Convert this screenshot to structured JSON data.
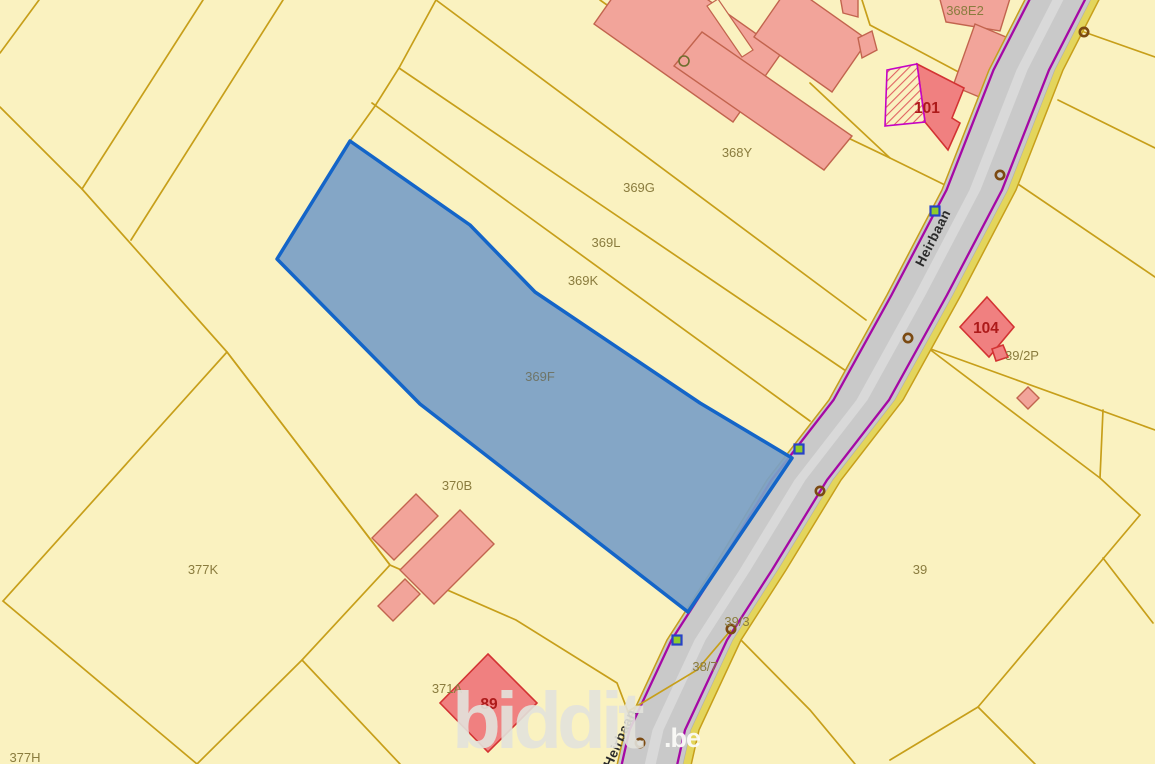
{
  "map": {
    "background": "#FAF2C0",
    "colors": {
      "parcel_line": "#C79F1A",
      "parcel_label": "#8A7C3E",
      "highlight_label": "#6F7568",
      "building_light_fill": "#F2A49A",
      "building_light_stroke": "#C2644E",
      "building_dark_fill": "#F08080",
      "building_dark_stroke": "#D33333",
      "building_number": "#AD1A1A",
      "hatch_line": "#E06060",
      "hatch_border": "#C503C5",
      "road_fill": "#C9C9C9",
      "road_edge": "#AFAFAF",
      "road_stripe": "#D9D9D9",
      "road_purple": "#A508A5",
      "road_band": "#E3D55C",
      "highlight_fill": "#7BA0C6",
      "highlight_stroke": "#1465C8",
      "marker_ring": "#7B4A12",
      "marker_circle": "#6E6E2E",
      "marker_square_stroke": "#2742C8",
      "marker_square_fill": "#8FCC2A",
      "street_text": "#2B2B2B",
      "watermark_main": "#E2E2DC",
      "watermark_suffix": "#FBFBF8"
    },
    "watermark": {
      "text": "biddit",
      "suffix": ".be",
      "x": 452,
      "y": 748,
      "suffix_x": 664,
      "suffix_y": 747
    },
    "street_labels": [
      {
        "text": "Heirbaan",
        "x": 937,
        "y": 240,
        "rotate": -63
      },
      {
        "text": "Heirbaan",
        "x": 624,
        "y": 740,
        "rotate": -66
      }
    ],
    "parcel_labels": [
      {
        "text": "368E2",
        "x": 965,
        "y": 15
      },
      {
        "text": "368Y",
        "x": 737,
        "y": 157
      },
      {
        "text": "369G",
        "x": 639,
        "y": 192
      },
      {
        "text": "369L",
        "x": 606,
        "y": 247
      },
      {
        "text": "369K",
        "x": 583,
        "y": 285
      },
      {
        "text": "370B",
        "x": 457,
        "y": 490
      },
      {
        "text": "377K",
        "x": 203,
        "y": 574
      },
      {
        "text": "377H",
        "x": 25,
        "y": 762
      },
      {
        "text": "371A",
        "x": 447,
        "y": 693
      },
      {
        "text": "39/2P",
        "x": 1022,
        "y": 360
      },
      {
        "text": "39",
        "x": 920,
        "y": 574
      },
      {
        "text": "39/3",
        "x": 737,
        "y": 626
      },
      {
        "text": "38/7",
        "x": 705,
        "y": 671
      }
    ],
    "building_numbers": [
      {
        "text": "101",
        "x": 927,
        "y": 113
      },
      {
        "text": "104",
        "x": 986,
        "y": 333
      },
      {
        "text": "89",
        "x": 489,
        "y": 709
      }
    ],
    "highlight_parcel": {
      "label": {
        "text": "369F",
        "x": 540,
        "y": 381
      },
      "points": [
        [
          350,
          141
        ],
        [
          470,
          225
        ],
        [
          535,
          292
        ],
        [
          700,
          403
        ],
        [
          792,
          458
        ],
        [
          740,
          535
        ],
        [
          688,
          612
        ],
        [
          420,
          404
        ],
        [
          277,
          259
        ]
      ]
    },
    "road": {
      "centerline": [
        [
          1064,
          -12
        ],
        [
          1022,
          70
        ],
        [
          975,
          190
        ],
        [
          920,
          295
        ],
        [
          862,
          400
        ],
        [
          800,
          480
        ],
        [
          745,
          570
        ],
        [
          700,
          640
        ],
        [
          658,
          730
        ],
        [
          644,
          792
        ]
      ],
      "halfwidth": 33
    },
    "boundary_lines": [
      [
        [
          0,
          53
        ],
        [
          39,
          0
        ]
      ],
      [
        [
          0,
          107
        ],
        [
          82,
          189
        ],
        [
          227,
          352
        ]
      ],
      [
        [
          203,
          0
        ],
        [
          82,
          189
        ]
      ],
      [
        [
          283,
          0
        ],
        [
          131,
          240
        ]
      ],
      [
        [
          227,
          352
        ],
        [
          3,
          601
        ],
        [
          197,
          764
        ],
        [
          302,
          660
        ],
        [
          390,
          565
        ],
        [
          227,
          352
        ]
      ],
      [
        [
          302,
          660
        ],
        [
          400,
          764
        ]
      ],
      [
        [
          227,
          352
        ],
        [
          390,
          565
        ],
        [
          516,
          620
        ],
        [
          617,
          683
        ],
        [
          640,
          743
        ],
        [
          658,
          764
        ]
      ],
      [
        [
          350,
          141
        ],
        [
          375,
          106
        ],
        [
          399,
          68
        ],
        [
          436,
          0
        ]
      ],
      [
        [
          436,
          0
        ],
        [
          866,
          320
        ]
      ],
      [
        [
          399,
          68
        ],
        [
          849,
          373
        ]
      ],
      [
        [
          372,
          103
        ],
        [
          810,
          421
        ]
      ],
      [
        [
          600,
          0
        ],
        [
          685,
          60
        ],
        [
          890,
          158
        ],
        [
          947,
          186
        ]
      ],
      [
        [
          810,
          83
        ],
        [
          890,
          158
        ]
      ],
      [
        [
          862,
          0
        ],
        [
          870,
          25
        ],
        [
          998,
          93
        ],
        [
          1016,
          102
        ]
      ],
      [
        [
          1084,
          32
        ],
        [
          1155,
          57
        ]
      ],
      [
        [
          1058,
          100
        ],
        [
          1155,
          148
        ]
      ],
      [
        [
          1012,
          180
        ],
        [
          1155,
          277
        ]
      ],
      [
        [
          928,
          348
        ],
        [
          1155,
          430
        ]
      ],
      [
        [
          928,
          348
        ],
        [
          1100,
          478
        ],
        [
          1140,
          515
        ]
      ],
      [
        [
          1103,
          410
        ],
        [
          1100,
          478
        ]
      ],
      [
        [
          1140,
          515
        ],
        [
          978,
          707
        ]
      ],
      [
        [
          978,
          707
        ],
        [
          1035,
          764
        ]
      ],
      [
        [
          978,
          707
        ],
        [
          890,
          760
        ]
      ],
      [
        [
          1103,
          558
        ],
        [
          1153,
          623
        ]
      ],
      [
        [
          735,
          634
        ],
        [
          810,
          710
        ],
        [
          855,
          764
        ]
      ]
    ],
    "over_road_lines": [
      [
        [
          731,
          630
        ],
        [
          697,
          670
        ],
        [
          627,
          712
        ]
      ]
    ],
    "buildings_light": [
      {
        "name": "building-complex-wing-1",
        "points": [
          [
            643,
            -46
          ],
          [
            782,
            52
          ],
          [
            733,
            122
          ],
          [
            594,
            24
          ]
        ]
      },
      {
        "name": "building-complex-wing-2",
        "points": [
          [
            702,
            32
          ],
          [
            852,
            136
          ],
          [
            824,
            170
          ],
          [
            674,
            66
          ]
        ]
      },
      {
        "name": "building-complex-wing-3",
        "points": [
          [
            790,
            -15
          ],
          [
            868,
            40
          ],
          [
            832,
            92
          ],
          [
            754,
            37
          ]
        ]
      },
      {
        "name": "building-small-top-1",
        "points": [
          [
            840,
            -4
          ],
          [
            858,
            -4
          ],
          [
            858,
            17
          ],
          [
            843,
            13
          ]
        ]
      },
      {
        "name": "building-small-top-2",
        "points": [
          [
            858,
            38
          ],
          [
            872,
            31
          ],
          [
            877,
            50
          ],
          [
            862,
            58
          ]
        ]
      },
      {
        "name": "building-top-right-1",
        "points": [
          [
            938,
            -8
          ],
          [
            1012,
            -8
          ],
          [
            1000,
            31
          ],
          [
            946,
            22
          ]
        ]
      },
      {
        "name": "building-top-right-2",
        "points": [
          [
            975,
            24
          ],
          [
            1018,
            42
          ],
          [
            996,
            104
          ],
          [
            953,
            86
          ]
        ]
      },
      {
        "name": "building-370b-1",
        "points": [
          [
            416,
            494
          ],
          [
            438,
            516
          ],
          [
            394,
            560
          ],
          [
            372,
            538
          ]
        ]
      },
      {
        "name": "building-370b-2",
        "points": [
          [
            460,
            510
          ],
          [
            494,
            544
          ],
          [
            434,
            604
          ],
          [
            400,
            570
          ]
        ]
      },
      {
        "name": "building-370b-3",
        "points": [
          [
            405,
            579
          ],
          [
            420,
            594
          ],
          [
            393,
            621
          ],
          [
            378,
            606
          ]
        ]
      },
      {
        "name": "building-small-39-2p",
        "points": [
          [
            1028,
            387
          ],
          [
            1039,
            398
          ],
          [
            1028,
            409
          ],
          [
            1017,
            398
          ]
        ]
      }
    ],
    "building_gap": {
      "points": [
        [
          742,
          57
        ],
        [
          753,
          50
        ],
        [
          718,
          -1
        ],
        [
          707,
          6
        ]
      ]
    },
    "buildings_dark": [
      {
        "name": "building-101",
        "points": [
          [
            917,
            64
          ],
          [
            964,
            88
          ],
          [
            952,
            118
          ],
          [
            960,
            123
          ],
          [
            948,
            150
          ],
          [
            925,
            122
          ]
        ]
      },
      {
        "name": "building-104",
        "points": [
          [
            987,
            297
          ],
          [
            1014,
            327
          ],
          [
            989,
            357
          ],
          [
            960,
            327
          ]
        ]
      },
      {
        "name": "building-104-annex",
        "points": [
          [
            992,
            349
          ],
          [
            1003,
            345
          ],
          [
            1008,
            357
          ],
          [
            996,
            361
          ]
        ]
      },
      {
        "name": "building-89",
        "points": [
          [
            488,
            654
          ],
          [
            537,
            703
          ],
          [
            488,
            752
          ],
          [
            440,
            703
          ]
        ]
      }
    ],
    "building_hatched": {
      "name": "building-101-hatched-part",
      "points": [
        [
          885,
          126
        ],
        [
          887,
          70
        ],
        [
          917,
          64
        ],
        [
          925,
          122
        ]
      ]
    },
    "markers": {
      "rings": [
        [
          1084,
          32
        ],
        [
          1000,
          175
        ],
        [
          908,
          338
        ],
        [
          820,
          491
        ],
        [
          731,
          629
        ],
        [
          640,
          743
        ]
      ],
      "squares": [
        [
          935,
          211
        ],
        [
          799,
          449
        ],
        [
          677,
          640
        ]
      ],
      "circles": [
        [
          684,
          61
        ]
      ]
    }
  }
}
